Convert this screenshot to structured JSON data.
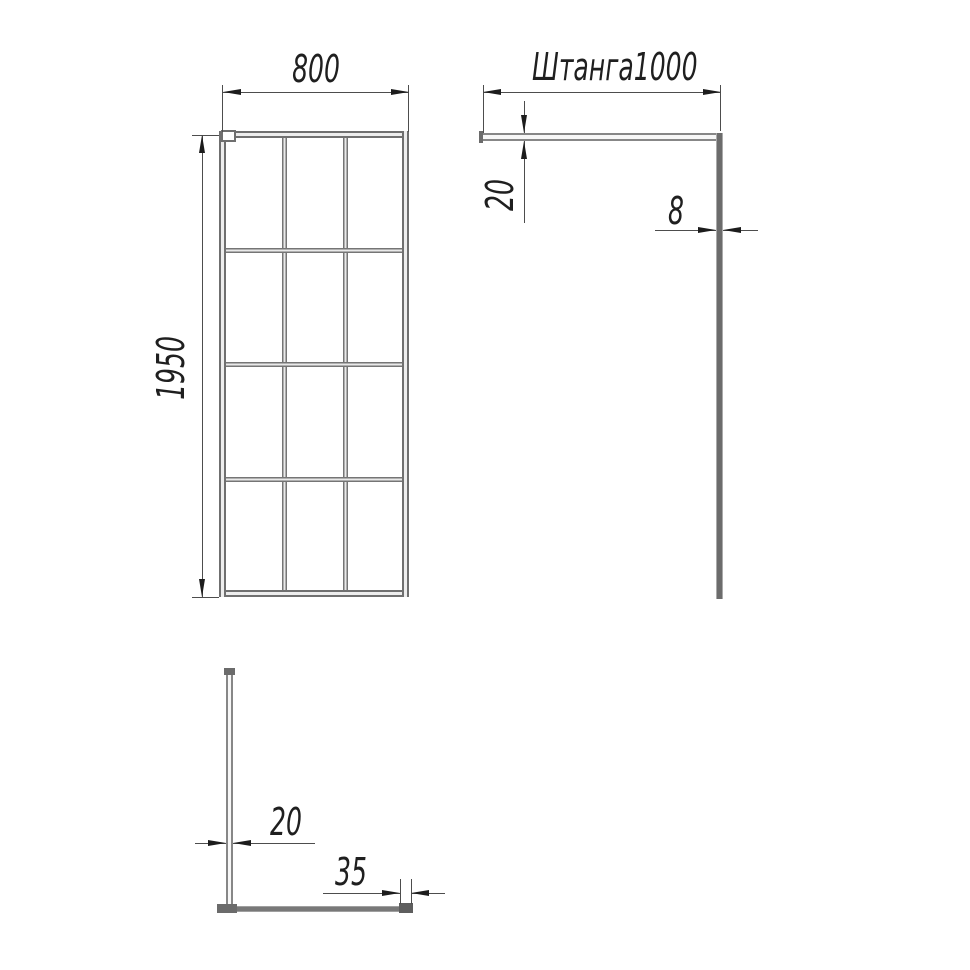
{
  "page": {
    "background": "#ffffff"
  },
  "colors": {
    "profile_gray": "#6f6f6f",
    "dimension_line": "#4d4d4d",
    "arrow": "#1c1c1c",
    "text": "#1f1f1f"
  },
  "front_view": {
    "description": "front view of framed glass screen with grid",
    "grid_columns": 3,
    "grid_rows": 4,
    "width_dim": "800",
    "height_dim": "1950"
  },
  "side_view": {
    "description": "side view: support rod at top, glass panel edge",
    "rod_length_dim": "Штанга1000",
    "rod_thickness_dim": "20",
    "glass_thickness_dim": "8"
  },
  "top_view": {
    "description": "top view: rod perpendicular to glass panel",
    "rod_width_dim": "20",
    "wall_profile_width_dim": "35"
  }
}
